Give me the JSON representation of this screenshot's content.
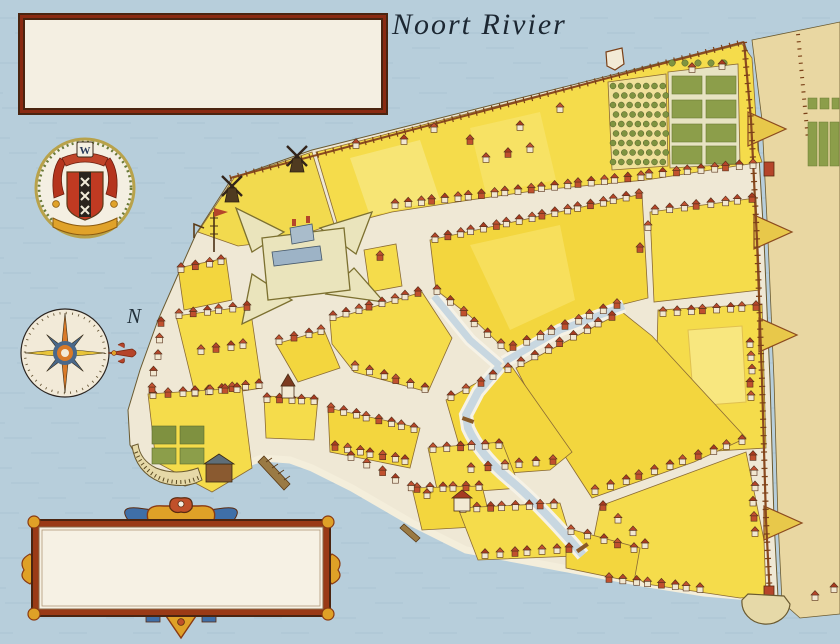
{
  "colors": {
    "water": "#b7cedb",
    "wave": "#a8c1d1",
    "city_ground": "#efe8d5",
    "outer_land": "#e9d7a2",
    "block_yellow": "#f5dc4b",
    "block_deep": "#f3d63e",
    "block_pale": "#f8e77f",
    "wall_brown": "#8b4a1f",
    "house_red": "#b5452a",
    "canal_water": "#c8d7e0",
    "legend_border": "#8a2a12",
    "panel_bg": "#f4efe2",
    "ink": "#241a10",
    "gold": "#dfa127",
    "blue_accent": "#3f6fa8",
    "garden_green": "#8c9e4a"
  },
  "header": {
    "river_title": "Noort Rivier",
    "anchorage_label": "Anchorage"
  },
  "legend": {
    "col1": [
      {
        "key": "i:",
        "name": " HEERE GRACHT."
      },
      {
        "key": "j:",
        "name": " PRINCE GRACHT."
      },
      {
        "key": "k:",
        "name": " BEGIJN GRACHT."
      },
      {
        "key": "l:",
        "name": " HOOGH STRAET."
      },
      {
        "key": "m:",
        "name": " PAEREL STRAET."
      },
      {
        "key": "n:",
        "name": " TUYN STRAET."
      },
      {
        "key": "o:",
        "name": " HEERE DWARS STRAET."
      }
    ],
    "col2": [
      {
        "key": "p:",
        "name": " SLYCK STEEG."
      },
      {
        "key": "q:",
        "name": " BRUGH STRAET."
      },
      {
        "key": "r:",
        "name": " STADT HUYS LAAN."
      },
      {
        "key": "s:",
        "name": " HET MARCKVELT STEEGIE."
      },
      {
        "key": "t:",
        "name": " HET  BEVER PAD."
      },
      {
        "key": "u:",
        "name": " BROUWER STRAET."
      }
    ]
  },
  "cartouche": {
    "lines": [
      {
        "cls": "l1",
        "parts": [
          {
            "t": "the ",
            "i": 0
          },
          {
            "t": "City",
            "i": 1
          },
          {
            "t": " of ",
            "i": 0
          },
          {
            "t": "New Amsterdam",
            "i": 1
          }
        ]
      },
      {
        "cls": "l2",
        "parts": [
          {
            "t": "on the ",
            "i": 0
          },
          {
            "t": "Island",
            "i": 1
          },
          {
            "t": " of ",
            "i": 0
          },
          {
            "t": "Manhattan",
            "i": 1
          }
        ]
      },
      {
        "cls": "l3",
        "parts": [
          {
            "t": "in the ",
            "i": 0
          },
          {
            "t": "Colony",
            "i": 1
          },
          {
            "t": " of ",
            "i": 0
          },
          {
            "t": "New Netherland",
            "i": 1
          },
          {
            "t": ". Anno 1660",
            "i": 0
          }
        ]
      }
    ]
  },
  "map": {
    "compass_north_label": "N",
    "arms_monogram": "W",
    "vertical_label": {
      "text": "HET CINGEL",
      "x": 764,
      "y": 198
    },
    "place_labels": [
      {
        "text": "DE HEERE STRAET",
        "x": 521,
        "y": 197,
        "rot": -7,
        "size": 13,
        "sp": 3.5
      },
      {
        "text": "PRINCE STRAET",
        "x": 705,
        "y": 300,
        "rot": -3,
        "size": 10.5,
        "sp": 2
      },
      {
        "text": "SMEE STRAET",
        "x": 655,
        "y": 471,
        "rot": -24,
        "size": 10.5,
        "sp": 1.5
      },
      {
        "text": "HET MARCKVELT",
        "x": 312,
        "y": 332,
        "rot": -24,
        "size": 11.5,
        "sp": 1
      },
      {
        "text": "FORT",
        "x": 314,
        "y": 227,
        "rot": 0,
        "size": 11,
        "sp": 2,
        "anchor": "start"
      },
      {
        "text": "AMSTERDAM",
        "x": 314,
        "y": 241,
        "rot": 0,
        "size": 11,
        "sp": 1.5,
        "anchor": "start"
      },
      {
        "text": "THE",
        "x": 799,
        "y": 374,
        "rot": 0,
        "size": 16,
        "sp": 1
      },
      {
        "text": "WALL",
        "x": 803,
        "y": 394,
        "rot": 0,
        "size": 16,
        "sp": 1
      },
      {
        "text": "Schreijer's Hoek",
        "x": 92,
        "y": 477,
        "rot": 0,
        "size": 14,
        "sp": 0.5
      }
    ],
    "block_letters": [
      {
        "t": "A",
        "x": 572,
        "y": 123
      },
      {
        "t": "B",
        "x": 703,
        "y": 244
      },
      {
        "t": "C",
        "x": 531,
        "y": 273
      },
      {
        "t": "D",
        "x": 382,
        "y": 355
      },
      {
        "t": "E",
        "x": 301,
        "y": 364
      },
      {
        "t": "E",
        "x": 372,
        "y": 445
      },
      {
        "t": "F",
        "x": 290,
        "y": 421
      },
      {
        "t": "G",
        "x": 231,
        "y": 356
      },
      {
        "t": "H",
        "x": 203,
        "y": 294
      },
      {
        "t": "J",
        "x": 203,
        "y": 412
      },
      {
        "t": "K",
        "x": 711,
        "y": 374
      },
      {
        "t": "L",
        "x": 613,
        "y": 392
      },
      {
        "t": "M",
        "x": 514,
        "y": 434
      },
      {
        "t": "N",
        "x": 471,
        "y": 476
      },
      {
        "t": "O",
        "x": 444,
        "y": 511
      },
      {
        "t": "P",
        "x": 496,
        "y": 532
      },
      {
        "t": "P",
        "x": 591,
        "y": 567
      },
      {
        "t": "Q",
        "x": 698,
        "y": 526
      },
      {
        "t": "R",
        "x": 381,
        "y": 274
      }
    ],
    "key_letters": [
      {
        "t": "a",
        "x": 302,
        "y": 180
      },
      {
        "t": "b",
        "x": 249,
        "y": 203
      },
      {
        "t": "c",
        "x": 497,
        "y": 148
      },
      {
        "t": "d",
        "x": 628,
        "y": 60
      },
      {
        "t": "e",
        "x": 787,
        "y": 177
      },
      {
        "t": "f",
        "x": 779,
        "y": 603
      },
      {
        "t": "g",
        "x": 280,
        "y": 492
      },
      {
        "t": "h",
        "x": 150,
        "y": 456
      },
      {
        "t": "i",
        "x": 458,
        "y": 418
      },
      {
        "t": "j",
        "x": 622,
        "y": 307
      },
      {
        "t": "k",
        "x": 428,
        "y": 293
      },
      {
        "t": "l",
        "x": 599,
        "y": 545
      },
      {
        "t": "m",
        "x": 181,
        "y": 331
      },
      {
        "t": "n",
        "x": 672,
        "y": 378
      },
      {
        "t": "o",
        "x": 645,
        "y": 247
      },
      {
        "t": "p",
        "x": 528,
        "y": 491
      },
      {
        "t": "q",
        "x": 288,
        "y": 377
      },
      {
        "t": "r",
        "x": 464,
        "y": 547
      },
      {
        "t": "s",
        "x": 371,
        "y": 288
      },
      {
        "t": "t",
        "x": 318,
        "y": 194
      },
      {
        "t": "u",
        "x": 323,
        "y": 348
      }
    ]
  }
}
